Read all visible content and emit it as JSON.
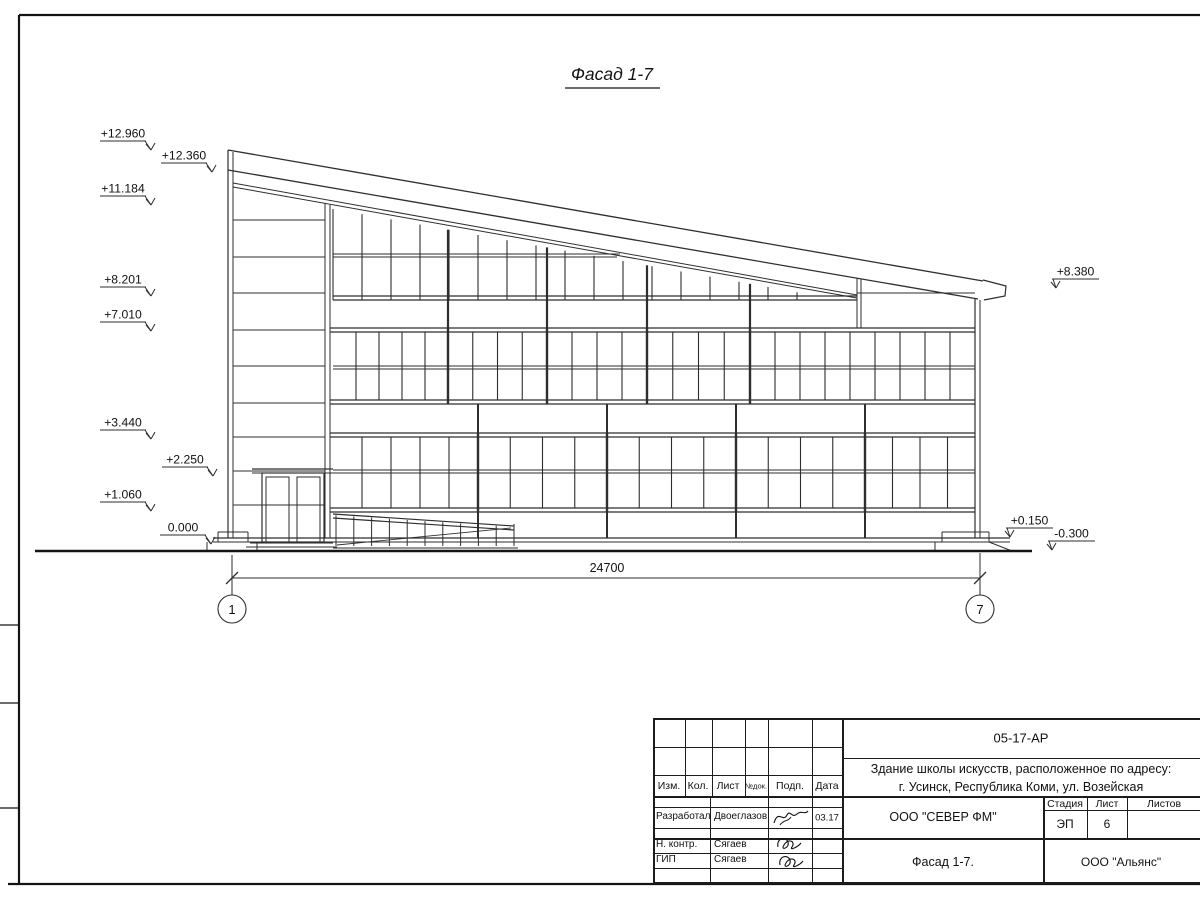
{
  "title": "Фасад 1-7",
  "drawing": {
    "marks_left": [
      {
        "value": "+12.960",
        "x": 146,
        "y": 141
      },
      {
        "value": "+12.360",
        "x": 207,
        "y": 163
      },
      {
        "value": "+11.184",
        "x": 146,
        "y": 196
      },
      {
        "value": "+8.201",
        "x": 146,
        "y": 287
      },
      {
        "value": "+7.010",
        "x": 146,
        "y": 322
      },
      {
        "value": "+3.440",
        "x": 146,
        "y": 430
      },
      {
        "value": "+2.250",
        "x": 208,
        "y": 467
      },
      {
        "value": "+1.060",
        "x": 146,
        "y": 502
      },
      {
        "value": "0.000",
        "x": 206,
        "y": 535
      }
    ],
    "marks_right": [
      {
        "value": "+8.380",
        "x": 1052,
        "y": 279
      },
      {
        "value": "+0.150",
        "x": 1006,
        "y": 528
      },
      {
        "value": "-0.300",
        "x": 1048,
        "y": 541
      }
    ],
    "dimension_value": "24700",
    "axis_left": "1",
    "axis_right": "7"
  },
  "stamp": {
    "doc_number": "05-17-АР",
    "description_line1": "Здание школы искусств, расположенное по адресу:",
    "description_line2": "г. Усинск, Республика Коми, ул. Возейская",
    "header_cols": [
      "Изм.",
      "Кол.",
      "Лист",
      "№док.",
      "Подп.",
      "Дата"
    ],
    "rows": [
      {
        "role": "Разработал",
        "name": "Двоеглазов",
        "date": "03.17"
      },
      {
        "role": "Н. контр.",
        "name": "Сягаев",
        "date": ""
      },
      {
        "role": "ГИП",
        "name": "Сягаев",
        "date": ""
      }
    ],
    "company": "ООО \"СЕВЕР ФМ\"",
    "sheet_title": "Фасад 1-7.",
    "contractor": "ООО \"Альянс\"",
    "stage_label": "Стадия",
    "stage_value": "ЭП",
    "sheet_label": "Лист",
    "sheet_value": "6",
    "sheets_label": "Листов"
  }
}
